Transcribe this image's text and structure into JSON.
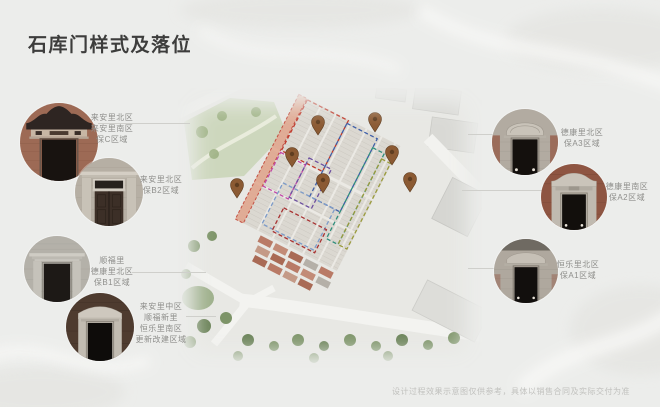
{
  "slide": {
    "title": "石库门样式及落位",
    "caption": "设计过程效果示意图仅供参考，具体以销售合同及实际交付为准"
  },
  "left_gates": [
    {
      "lines": [
        "来安里北区",
        "来安里南区",
        "保C区域"
      ]
    },
    {
      "lines": [
        "来安里北区",
        "保B2区域"
      ]
    },
    {
      "lines": [
        "顺福里",
        "德康里北区",
        "保B1区域"
      ]
    },
    {
      "lines": [
        "来安里中区",
        "顺福新里",
        "恒乐里南区",
        "更新改建区域"
      ]
    }
  ],
  "right_gates": [
    {
      "lines": [
        "德康里北区",
        "保A3区域"
      ]
    },
    {
      "lines": [
        "德康里南区",
        "保A2区域"
      ]
    },
    {
      "lines": [
        "恒乐里北区",
        "保A1区域"
      ]
    }
  ],
  "map": {
    "pin_color": "#8b5a33",
    "zone_outline_colors": [
      "#c0392b",
      "#3e5fa8",
      "#c149a8",
      "#6c4fa0",
      "#2f8e7c",
      "#9a9b3c",
      "#7c9bc9",
      "#a83232"
    ]
  }
}
